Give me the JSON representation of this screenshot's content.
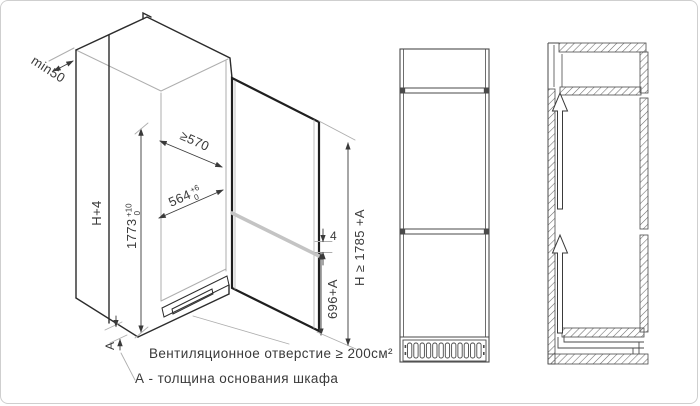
{
  "diagram": {
    "type": "built-in refrigerator installation drawing",
    "colors": {
      "line": "#3a3a3a",
      "construction": "#a9a9a9",
      "door_split_band": "#c4c4c4",
      "background": "#ffffff",
      "frame_border": "#cfcfcf"
    }
  },
  "dimensions": {
    "rear_gap": "min50",
    "cabinet_height": "H+4",
    "niche_height": {
      "value": "1773",
      "tol_plus": "+10",
      "tol_minus": "0"
    },
    "niche_depth": "≥570",
    "niche_width": {
      "value": "564",
      "tol_plus": "+6",
      "tol_minus": "0"
    },
    "door_gap": "4",
    "freezer_door_height": "696+A",
    "overall_height": "H ≥ 1785 +A",
    "base_thickness_symbol": "A"
  },
  "notes": {
    "ventilation": "Вентиляционное отверстие ≥ 200см²",
    "base_thickness": "А - толщина основания шкафа"
  }
}
